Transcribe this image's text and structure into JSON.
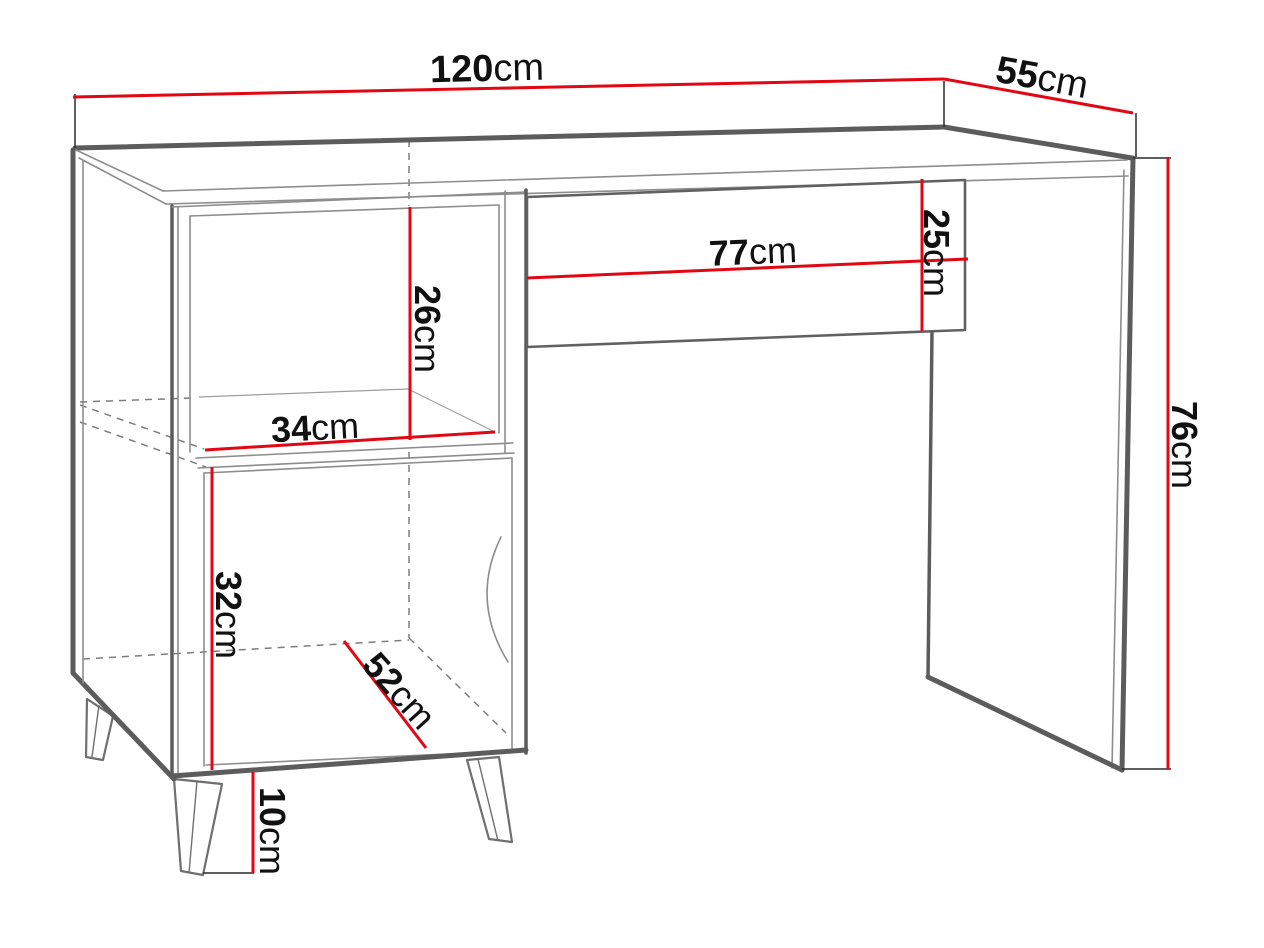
{
  "colors": {
    "dimension-red": "#e30613",
    "outline-dark": "#5c5c5c",
    "outline-mid": "#6f6f6f",
    "outline-light": "#8d8d8d",
    "text-black": "#111111",
    "background": "#ffffff"
  },
  "diagram": {
    "kind": "furniture-dimension-drawing",
    "unit": "cm",
    "dimensions": {
      "width": {
        "value": "120",
        "unit": "cm"
      },
      "depth": {
        "value": "55",
        "unit": "cm"
      },
      "drawer_width": {
        "value": "77",
        "unit": "cm"
      },
      "drawer_height": {
        "value": "25",
        "unit": "cm"
      },
      "shelf_height": {
        "value": "26",
        "unit": "cm"
      },
      "shelf_width": {
        "value": "34",
        "unit": "cm"
      },
      "cabinet_height": {
        "value": "32",
        "unit": "cm"
      },
      "cabinet_depth": {
        "value": "52",
        "unit": "cm"
      },
      "leg_height": {
        "value": "10",
        "unit": "cm"
      },
      "total_height": {
        "value": "76",
        "unit": "cm"
      }
    }
  }
}
